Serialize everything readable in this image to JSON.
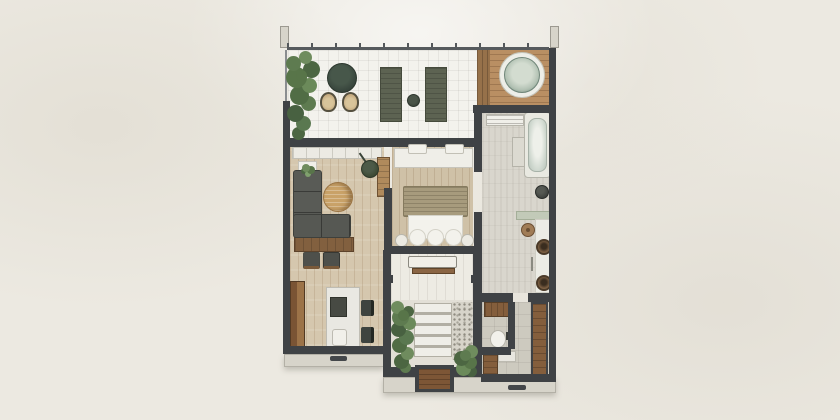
{
  "scene": {
    "kind": "architectural floor plan rendering, top-down view of a one-bedroom suite",
    "visible_text": "none",
    "background_color": "#ece9e1",
    "wall_color": "#3f4245",
    "accent_colors": {
      "wood_floor": "#d5c7ae",
      "deck_wood": "#b98f63",
      "furniture_wood": "#8a6141",
      "sofa_gray": "#595b56",
      "plant_green": "#5d7b4f",
      "water_teal": "#aebfb0",
      "step_gray": "#d7d4ca",
      "linen_white": "#f3f2ec",
      "sage": "#c2cab8"
    }
  },
  "rooms": [
    {
      "name": "terrace",
      "floor": "white tile, open railing",
      "items": [
        "tree",
        "round-daybed",
        "wicker-chair x2",
        "sun-lounger x2",
        "round-side-table"
      ]
    },
    {
      "name": "hot-tub-deck",
      "floor": "timber deck",
      "items": [
        "hot-tub"
      ]
    },
    {
      "name": "living-room",
      "floor": "timber",
      "items": [
        "wall-shelf",
        "plant-on-shelf",
        "hanging-lamp",
        "l-shaped-sofa",
        "round-coffee-table",
        "pouf x2",
        "closet"
      ]
    },
    {
      "name": "study-corner",
      "floor": "timber",
      "items": [
        "wardrobe",
        "desk",
        "laptop",
        "desk-chair",
        "side-chair x2"
      ]
    },
    {
      "name": "bedroom",
      "floor": "timber",
      "items": [
        "headboard-console",
        "pillow x2",
        "double-bed",
        "duvet",
        "round-stool x2"
      ]
    },
    {
      "name": "inner-patio",
      "floor": "white tile",
      "items": [
        "bench"
      ]
    },
    {
      "name": "garden-courtyard",
      "floor": "stone steps and pebbles",
      "items": [
        "planting-strip",
        "stepping-slabs",
        "pebble-bed",
        "shrub",
        "garden-door"
      ]
    },
    {
      "name": "bathroom",
      "floor": "pale stone",
      "items": [
        "shower-bench",
        "bathtub",
        "side-table",
        "dark-stool",
        "glass-screen",
        "vanity-counter",
        "wood-stool",
        "vessel-sink x2"
      ]
    },
    {
      "name": "wc",
      "floor": "gray tile",
      "items": [
        "cabinet",
        "toilet",
        "low-cabinet"
      ]
    },
    {
      "name": "entry-corridor",
      "floor": "gray tile",
      "items": [
        "tall-wardrobe",
        "entry-door-handle"
      ]
    }
  ]
}
